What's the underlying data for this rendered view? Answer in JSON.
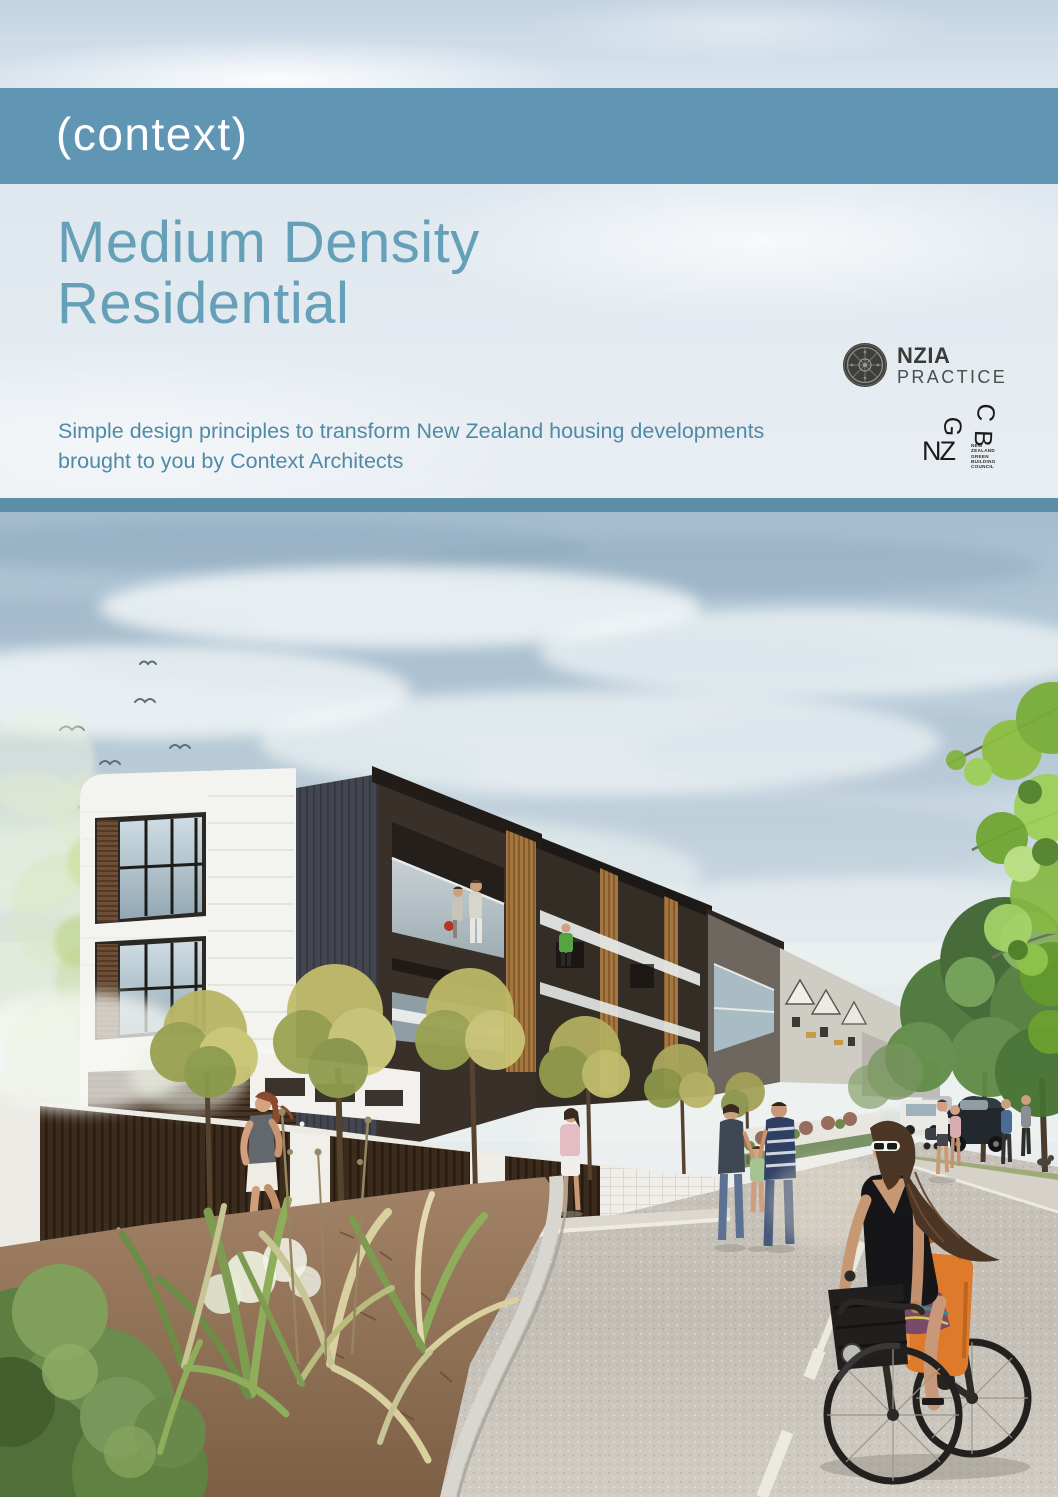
{
  "brand": {
    "logo_text": "(context)",
    "band_color": "#6095b3"
  },
  "hero": {
    "title_line1": "Medium Density",
    "title_line2": "Residential",
    "title_color": "#66a0b8",
    "subtitle_line1": "Simple design principles to transform New Zealand housing developments",
    "subtitle_line2": "brought to you by Context Architects",
    "subtitle_color": "#4f8aa6",
    "separator_color": "#5d8ea7"
  },
  "logos": {
    "nzia": {
      "name": "NZIA",
      "line2": "PRACTICE"
    },
    "nzgbc": {
      "nz": "NZ",
      "g": "G",
      "b": "B",
      "c": "C",
      "small_lines": [
        "NEW",
        "ZEALAND",
        "GREEN",
        "BUILDING",
        "COUNCIL"
      ]
    }
  },
  "photo": {
    "alt": "Architectural render of a medium-density residential street: three-storey terraced apartments with timber battens and balconies, street trees, pedestrians, a jogger, parked cars and a woman cycling with an orange pannier bag",
    "colors": {
      "sky": "#c3d3de",
      "road": "#c6c1b9",
      "foliage": "#7d9c50",
      "timber": "#a5763f"
    }
  }
}
